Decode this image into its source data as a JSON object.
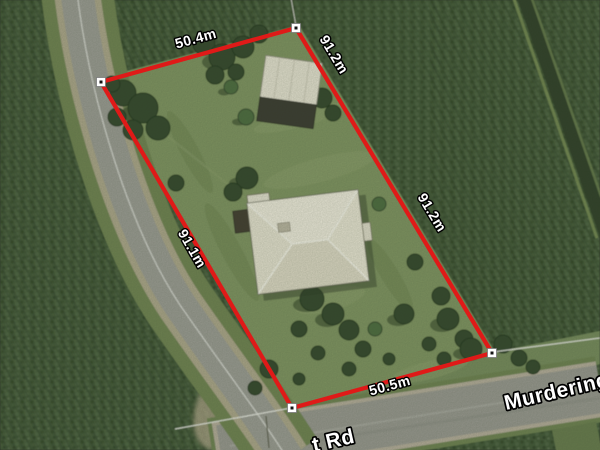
{
  "map": {
    "boundary": {
      "color": "#df1a18",
      "points": "101,82 296,28 492,353 292,408",
      "corner_markers": [
        {
          "transform": "translate(101 82)"
        },
        {
          "transform": "translate(296 28)"
        },
        {
          "transform": "translate(492 353)"
        },
        {
          "transform": "translate(292 408)"
        }
      ]
    },
    "measurements": {
      "top": "50.4m",
      "right_upper": "91.2m",
      "right_lower": "91.2m",
      "left": "91.1m",
      "bottom": "50.5m"
    },
    "roads": {
      "name_visible": "Murdering P",
      "name_partial": "t Rd"
    },
    "colors": {
      "cane_field": "#3f5433",
      "lawn": "#7e925f",
      "road_asphalt": "#9a9a92",
      "boundary_red": "#df1a18",
      "marker_fill": "#ffffff",
      "marker_dot": "#141414"
    }
  }
}
